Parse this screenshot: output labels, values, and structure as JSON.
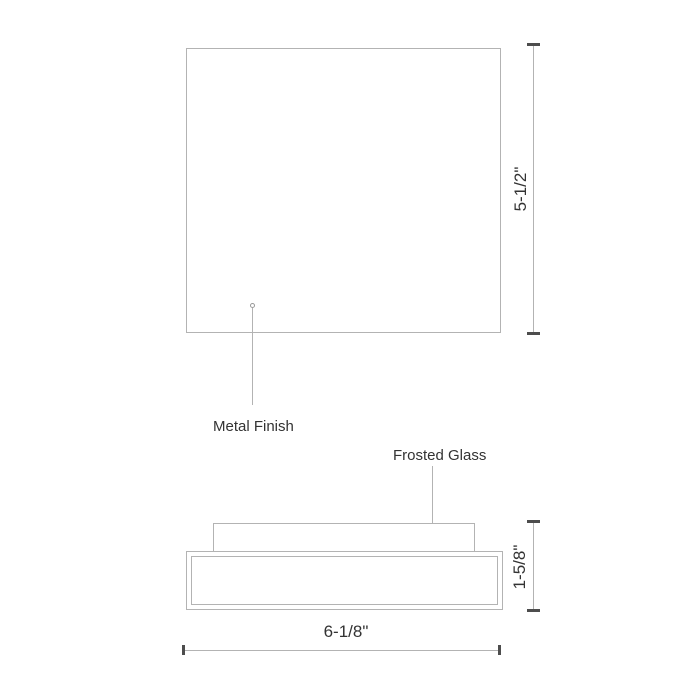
{
  "drawing": {
    "plan_view": {
      "height_dimension_label": "5-1/2\"",
      "callout_label": "Metal Finish"
    },
    "side_view": {
      "callout_label": "Frosted Glass",
      "height_dimension_label": "1-5/8\"",
      "width_dimension_label": "6-1/8\""
    },
    "colors": {
      "outline_gray": "#b3b3b3",
      "tick_dark": "#4d4d4d",
      "text": "#333333",
      "background": "#ffffff"
    }
  }
}
